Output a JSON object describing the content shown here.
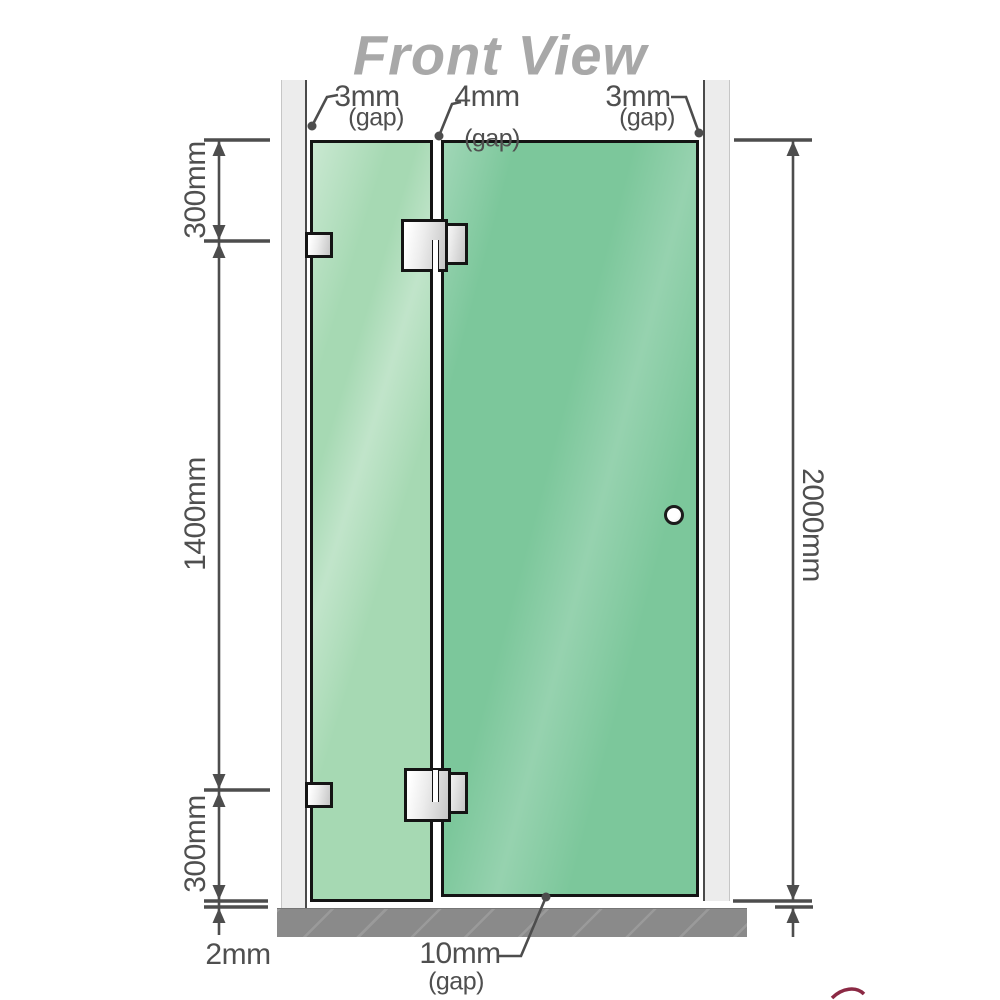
{
  "title": "Front View",
  "labels": {
    "gap_left_value": "3mm",
    "gap_left_qualifier": "(gap)",
    "gap_middle_value": "4mm",
    "gap_middle_qualifier": "(gap)",
    "gap_right_value": "3mm",
    "gap_right_qualifier": "(gap)",
    "left_top_segment": "300mm",
    "left_middle_segment": "1400mm",
    "left_bottom_segment": "300mm",
    "right_total_height": "2000mm",
    "bottom_floor_gap": "2mm",
    "bottom_door_gap_value": "10mm",
    "bottom_door_gap_qualifier": "(gap)"
  },
  "colors": {
    "fixed_panel_glass": "#a6d9b3",
    "door_panel_glass": "#7cc79b",
    "wall_channel": "#ececec",
    "floor_base": "#8a8a8a",
    "dimension_lines": "#4d4d4d",
    "dimension_text": "#4f4f4f",
    "title_text": "#a8a8a8",
    "hardware_fill": "#ececec",
    "glass_border": "#141414",
    "logo_swoosh_accent": "#7e1230"
  }
}
